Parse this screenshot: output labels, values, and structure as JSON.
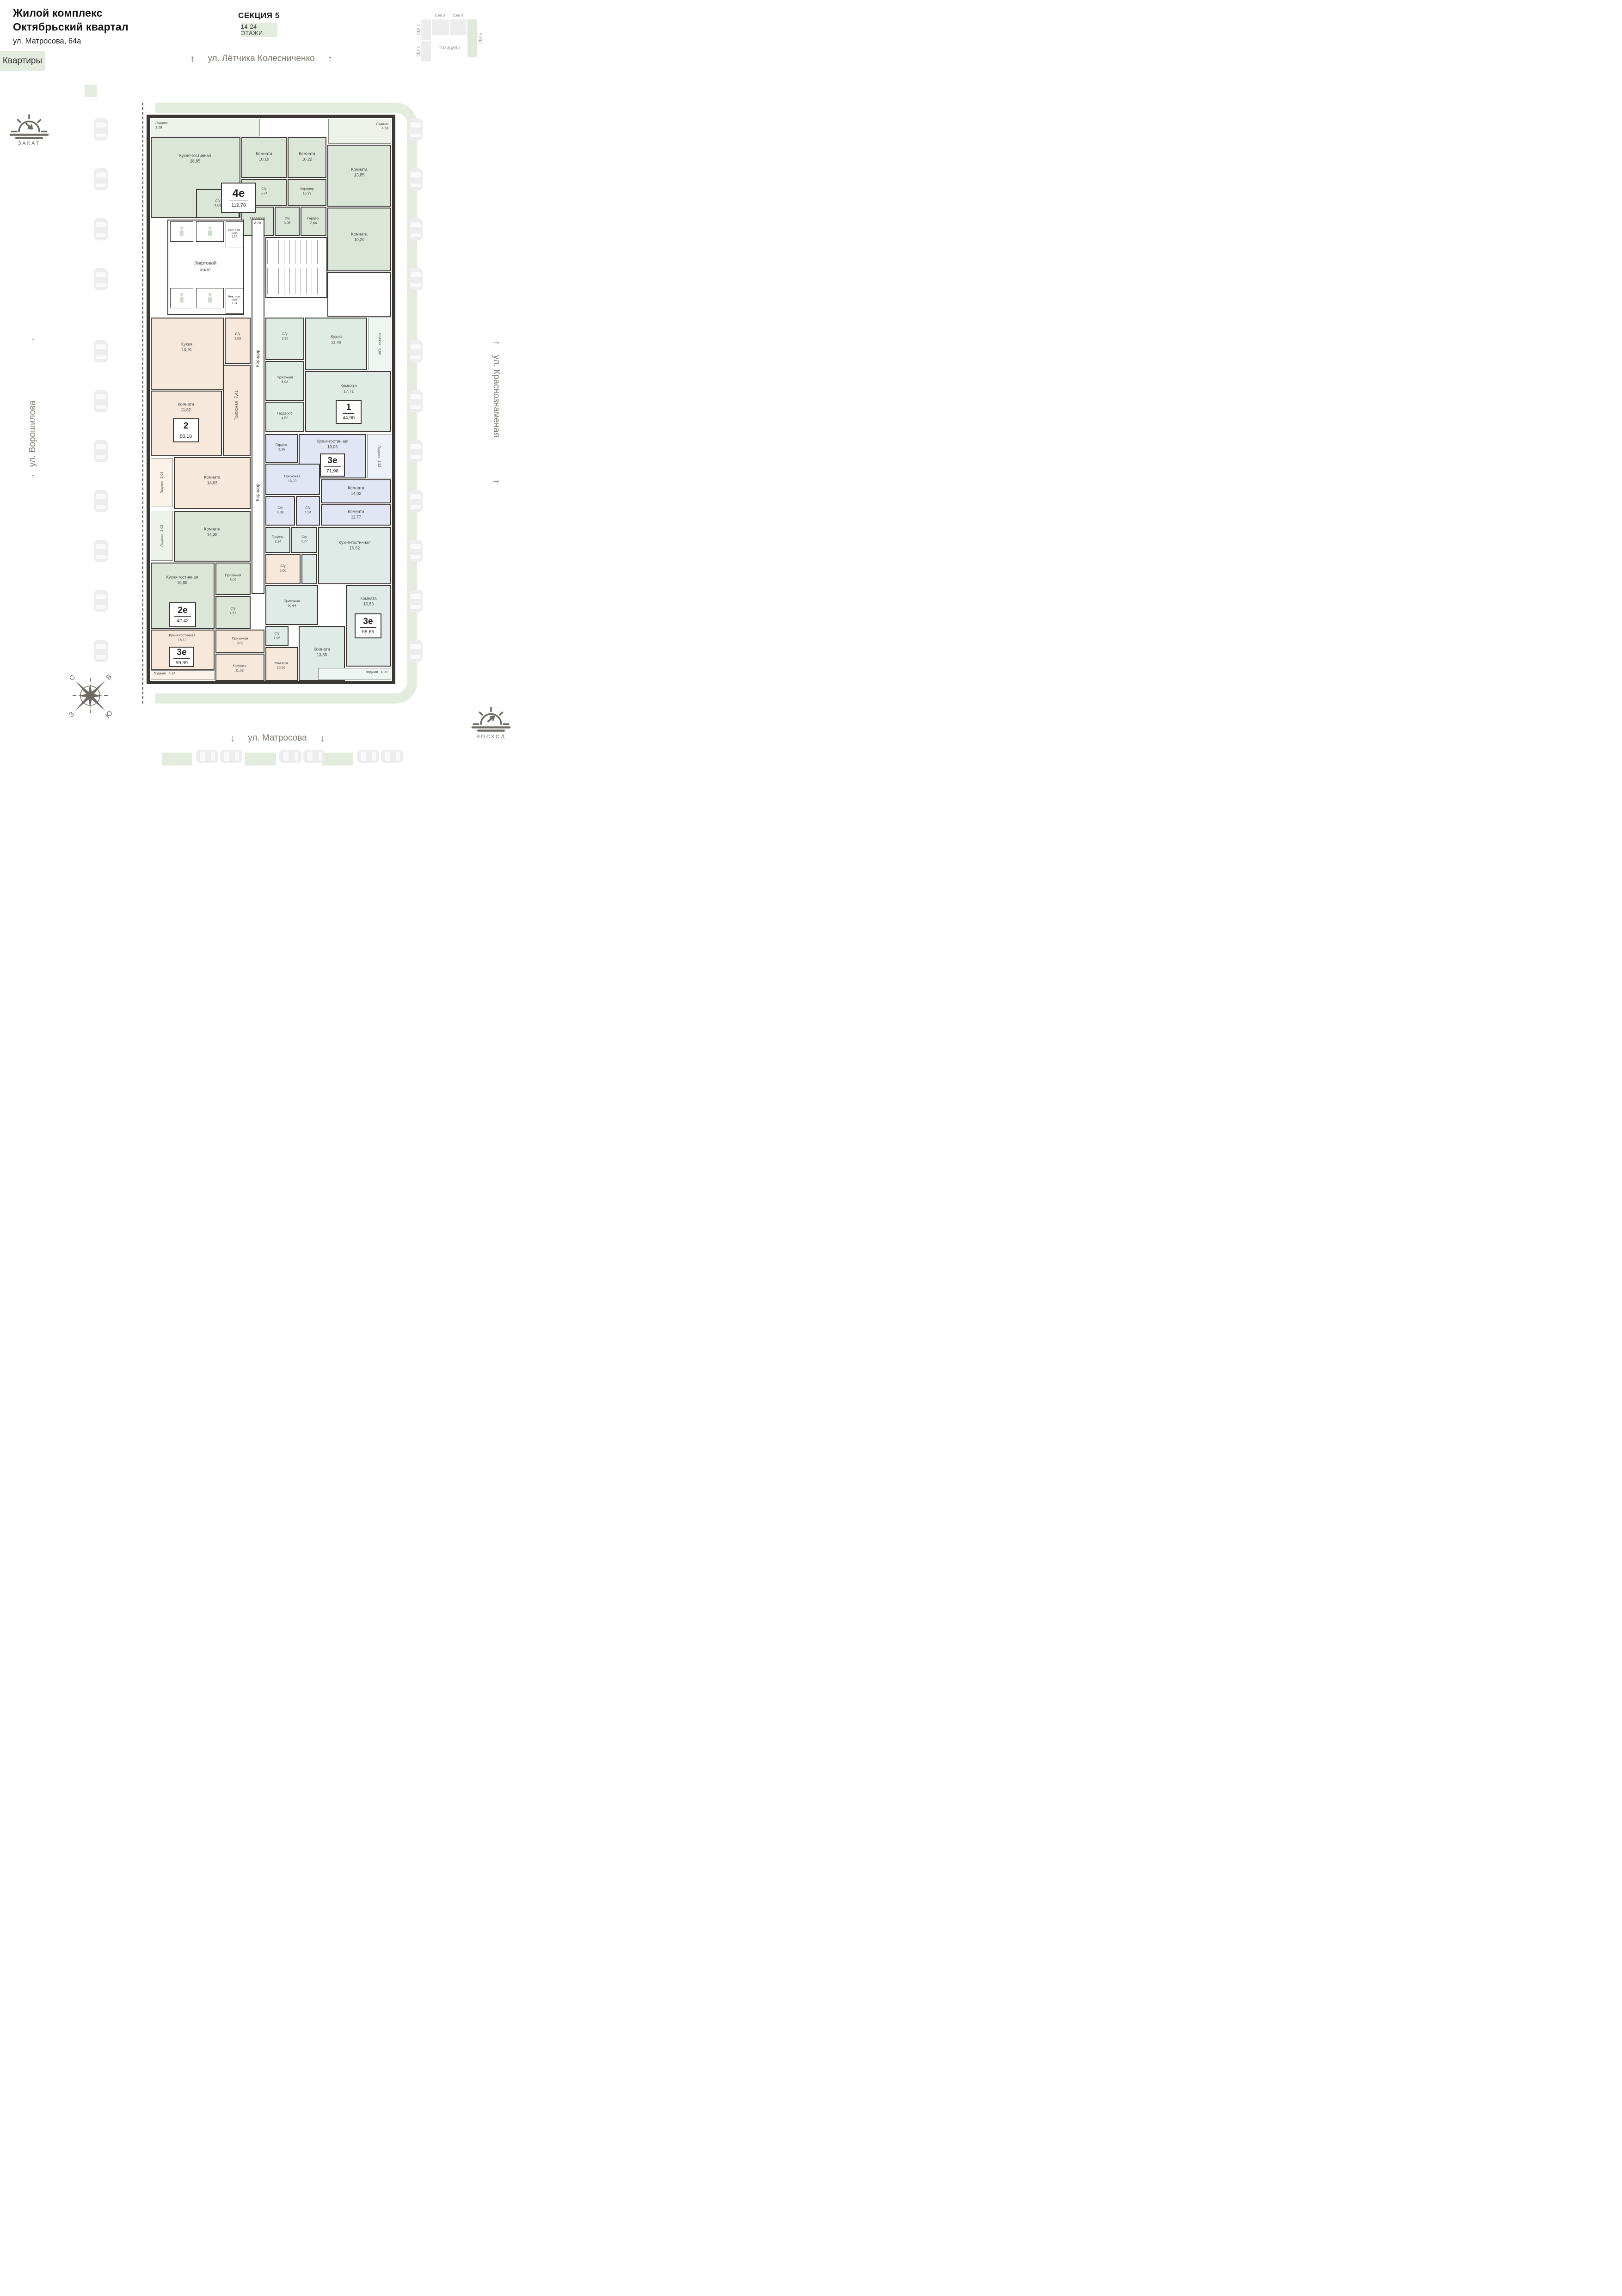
{
  "header": {
    "complex_line1": "Жилой комплекс",
    "complex_line2": "Октябрьский квартал",
    "address": "ул. Матросова, 64а",
    "apartments_badge": "Квартиры"
  },
  "section": {
    "title": "СЕКЦИЯ 5",
    "floors_badge": "14-24 ЭТАЖИ"
  },
  "minimap": {
    "sec1": "СЕК 1",
    "sec2": "СЕК 2",
    "sec3": "СЕК 3",
    "sec4": "СЕК 4",
    "sec5": "СЕК 5",
    "position": "ПОЗИЦИЯ 3",
    "active_section": "СЕК 5"
  },
  "streets": {
    "top": "ул. Лётчика Колесниченко",
    "left": "ул. Ворошилова",
    "right": "ул. Краснознаменая",
    "bottom": "ул. Матросова"
  },
  "sun": {
    "sunset": "ЗАКАТ",
    "sunrise": "ВОСХОД"
  },
  "compass": {
    "north": "С",
    "east": "В",
    "west": "З",
    "south": "Ю"
  },
  "core": {
    "lift_hall": "Лифтовой холл",
    "corridor": "Коридор",
    "nonres65": {
      "name": "Неж. пом. №65",
      "area": "1,17"
    },
    "nonres66": {
      "name": "Неж. пом. №66",
      "area": "1,34"
    }
  },
  "apartments": [
    {
      "id": "4е",
      "total": "112,78",
      "rooms": [
        {
          "name": "Лоджия",
          "area": "3,28"
        },
        {
          "name": "Кухня-гостинная",
          "area": "28,85"
        },
        {
          "name": "Комната",
          "area": "10,19"
        },
        {
          "name": "Комната",
          "area": "10,22"
        },
        {
          "name": "Лоджия",
          "area": "4,08"
        },
        {
          "name": "Комната",
          "area": "13,85"
        },
        {
          "name": "Коридор",
          "area": "16,39"
        },
        {
          "name": "С/у",
          "area": "5,74"
        },
        {
          "name": "С/у",
          "area": "4,68"
        },
        {
          "name": "Гардероб",
          "area": "3,29"
        },
        {
          "name": "С/у",
          "area": "3,05"
        },
        {
          "name": "Гардер.",
          "area": "2,64"
        },
        {
          "name": "Комната",
          "area": "10,20"
        }
      ]
    },
    {
      "id": "2",
      "total": "50,18",
      "rooms": [
        {
          "name": "Кухня",
          "area": "10,91"
        },
        {
          "name": "С/у",
          "area": "3,89"
        },
        {
          "name": "Прихожая",
          "area": "7,41"
        },
        {
          "name": "Комната",
          "area": "11,82"
        },
        {
          "name": "Комната",
          "area": "14,63"
        },
        {
          "name": "Лоджия",
          "area": "3,03"
        }
      ]
    },
    {
      "id": "1",
      "total": "44,90",
      "rooms": [
        {
          "name": "С/у",
          "area": "3,90"
        },
        {
          "name": "Кухня",
          "area": "11,49"
        },
        {
          "name": "Лоджия",
          "area": "2,60"
        },
        {
          "name": "Прихожая",
          "area": "5,98"
        },
        {
          "name": "Гардероб",
          "area": "4,52"
        },
        {
          "name": "Комната",
          "area": "17,71"
        }
      ]
    },
    {
      "id": "3е",
      "total": "71,96",
      "rooms": [
        {
          "name": "Гардер.",
          "area": "3,36"
        },
        {
          "name": "Кухня-гостинная",
          "area": "19,05"
        },
        {
          "name": "Лоджия",
          "area": "3,32"
        },
        {
          "name": "Прихожая",
          "area": "13,22"
        },
        {
          "name": "Комната",
          "area": "14,02"
        },
        {
          "name": "С/у",
          "area": "4,39"
        },
        {
          "name": "С/у",
          "area": "4,34"
        },
        {
          "name": "Комната",
          "area": "11,77"
        }
      ]
    },
    {
      "id": "2е",
      "total": "42,42",
      "rooms": [
        {
          "name": "Лоджия",
          "area": "3,03"
        },
        {
          "name": "Комната",
          "area": "14,35"
        },
        {
          "name": "Кухня-гостинная",
          "area": "16,89"
        },
        {
          "name": "Прихожая",
          "area": "5,09"
        },
        {
          "name": "С/у",
          "area": "4,57"
        }
      ]
    },
    {
      "id": "3е",
      "total": "59,39",
      "rooms": [
        {
          "name": "С/у",
          "area": "6,00"
        },
        {
          "name": "Прихожая",
          "area": "8,02"
        },
        {
          "name": "Кухня-гостинная",
          "area": "18,12"
        },
        {
          "name": "Комната",
          "area": "11,62"
        },
        {
          "name": "Комната",
          "area": "13,56"
        },
        {
          "name": "Лоджия",
          "area": "4,14"
        }
      ]
    },
    {
      "id": "3е",
      "total": "68,66",
      "rooms": [
        {
          "name": "Гардер.",
          "area": "2,24"
        },
        {
          "name": "С/у",
          "area": "4,77"
        },
        {
          "name": "Кухня-гостинная",
          "area": "16,62"
        },
        {
          "name": "Прихожая",
          "area": "10,66"
        },
        {
          "name": "С/у",
          "area": "1,95"
        },
        {
          "name": "Комната",
          "area": "13,55"
        },
        {
          "name": "Комната",
          "area": "16,83"
        },
        {
          "name": "Лоджия",
          "area": "4,08"
        }
      ]
    }
  ],
  "colors": {
    "wall": "#3b3733",
    "sage": "#dbe5d8",
    "peach": "#f7e8dc",
    "mint": "#e1ebe5",
    "lavender": "#e2e5f3",
    "teal": "#e0ebe8",
    "walkway": "#e4ebdf",
    "muted_text": "#7e786f"
  }
}
